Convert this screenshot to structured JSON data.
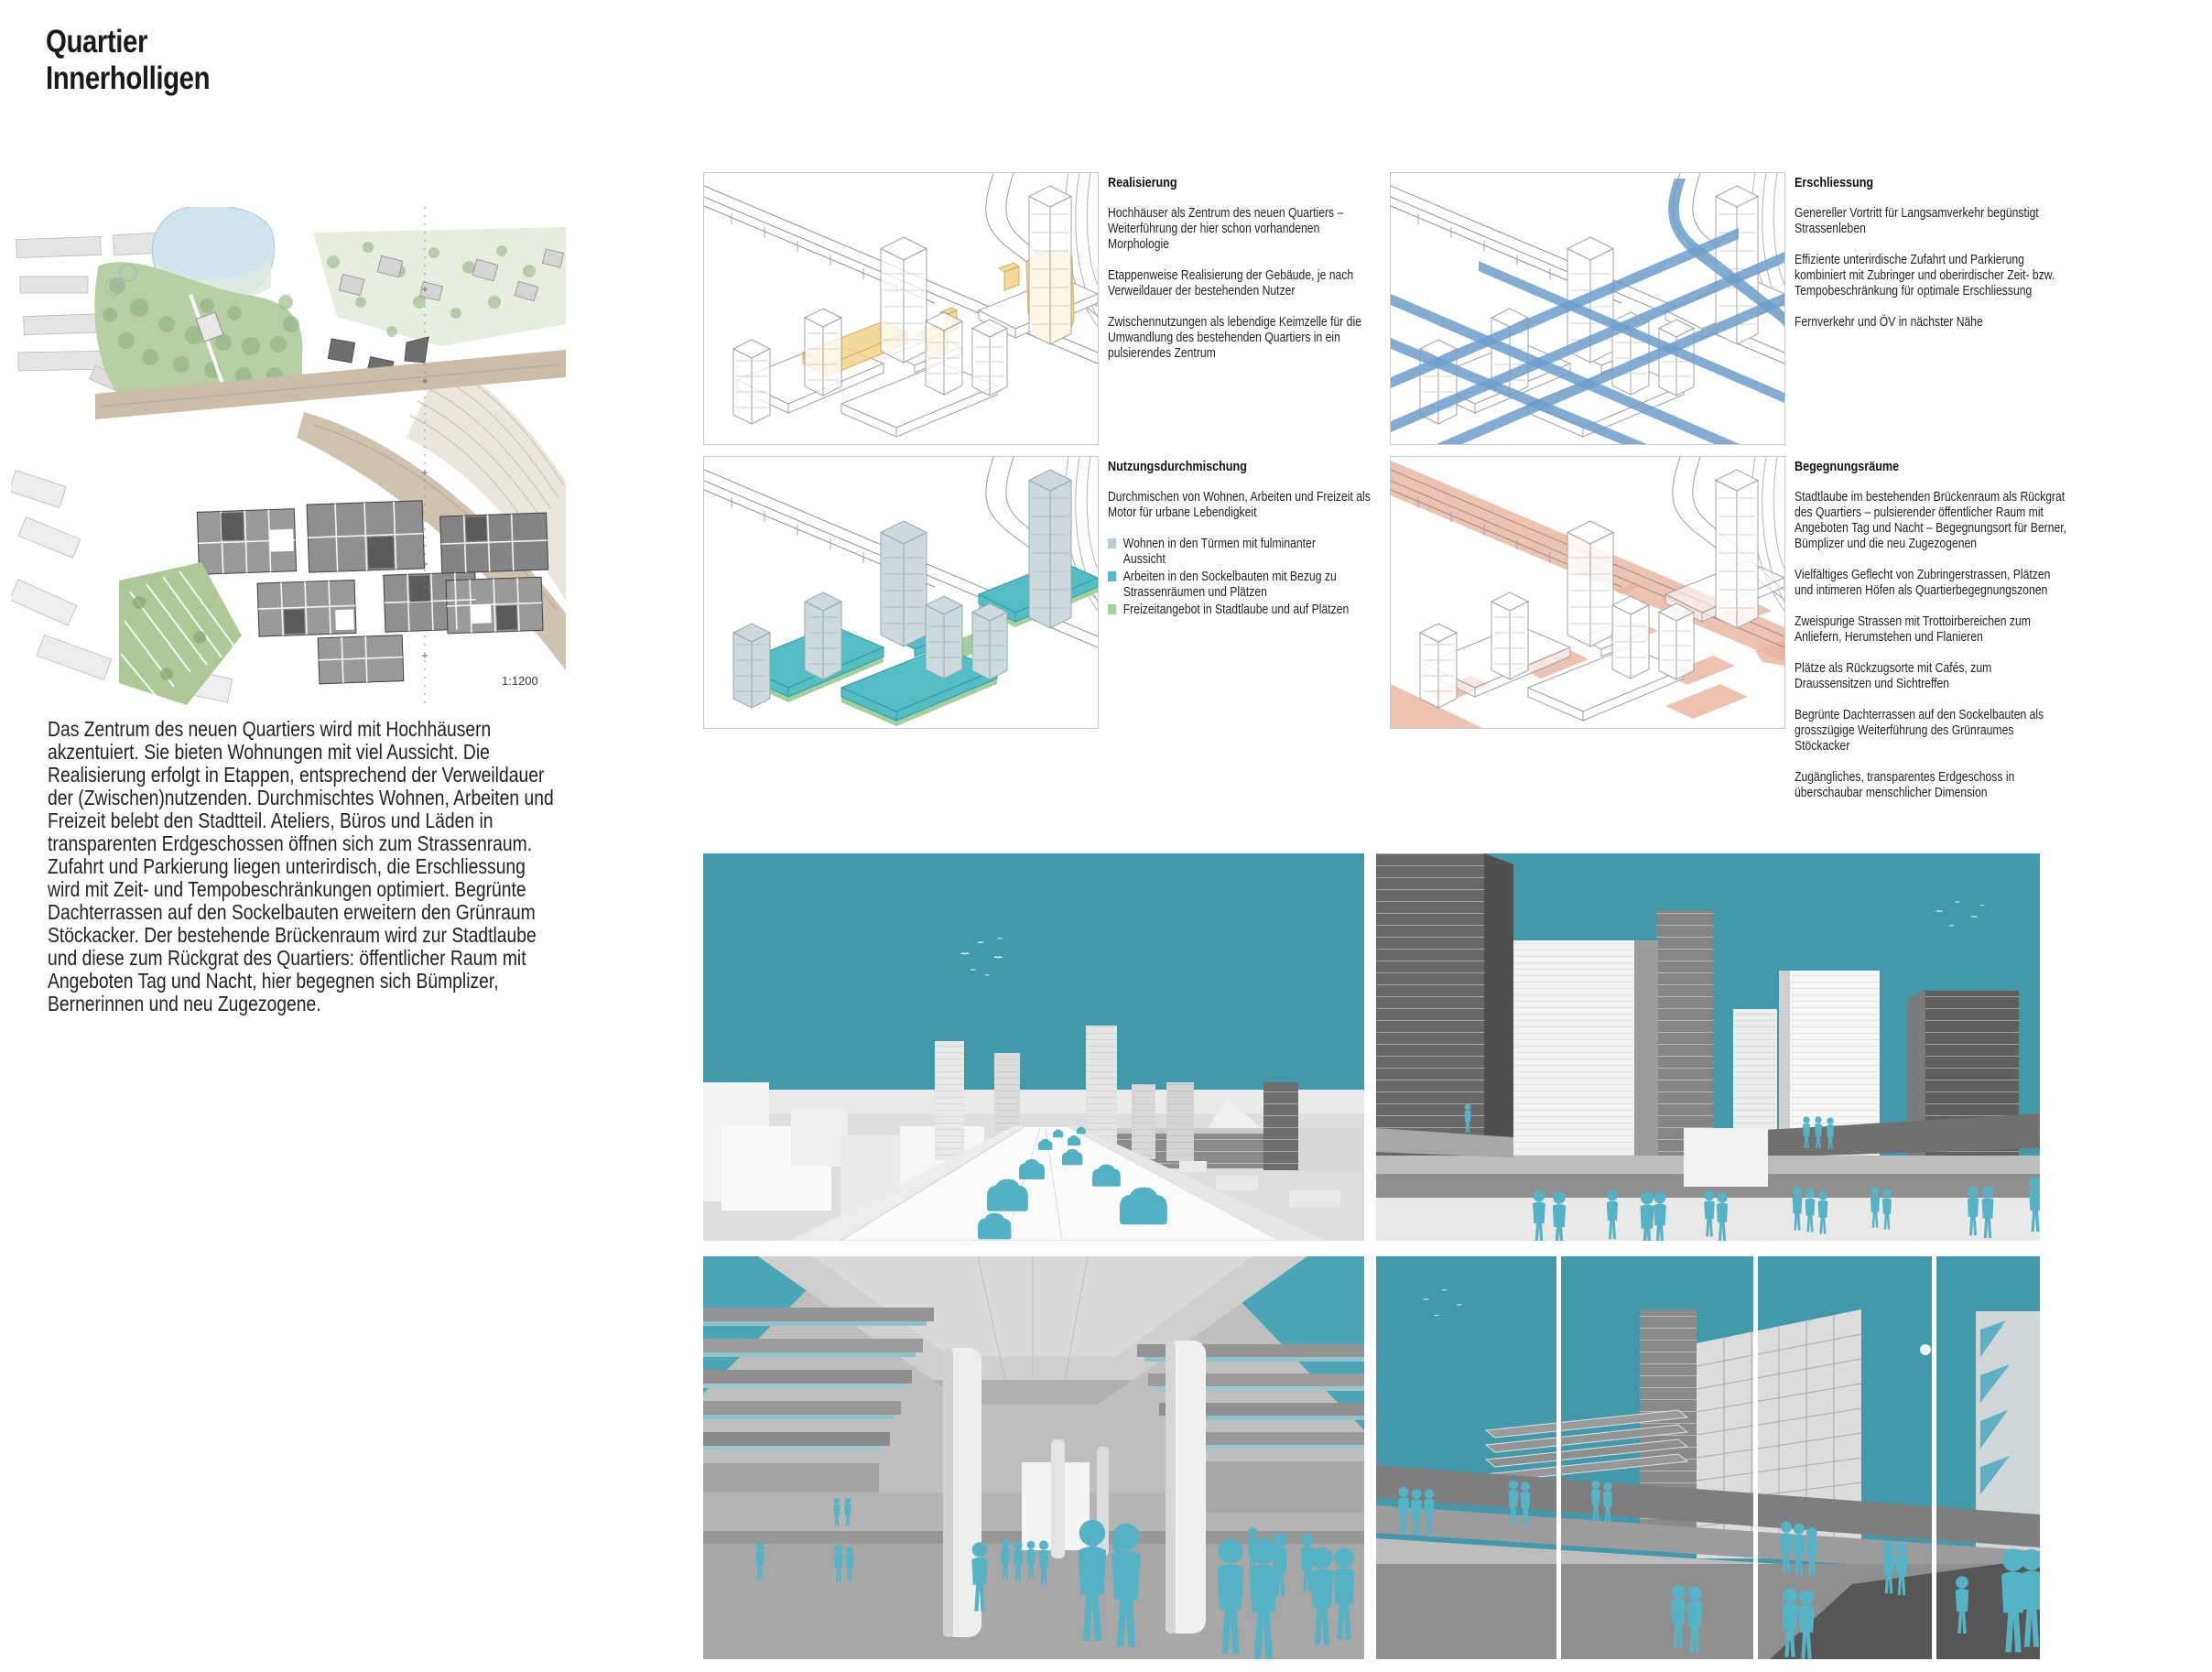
{
  "page": {
    "title_line1": "Quartier",
    "title_line2": "Innerholligen"
  },
  "map": {
    "scale_label": "1:1200"
  },
  "intro_paragraph": "Das Zentrum des neuen Quartiers wird mit Hochhäusern akzentuiert. Sie bieten Wohnungen mit viel Aussicht. Die Realisierung erfolgt in Etappen, entsprechend der Verweildauer der (Zwischen)nutzenden. Durchmischtes Wohnen, Arbeiten und Freizeit belebt den Stadtteil. Ateliers, Büros und Läden in transparenten Erdgeschossen öffnen sich zum Strassenraum. Zufahrt und Parkierung liegen unterirdisch, die Erschliessung wird mit Zeit- und Tempobeschränkungen optimiert. Begrünte Dachterrassen auf den Sockelbauten erweitern den Grünraum Stöckacker. Der bestehende Brückenraum wird zur Stadtlaube und diese zum Rückgrat des Quartiers: öffentlicher Raum mit Angeboten Tag und Nacht, hier begegnen sich Bümplizer, Bernerinnen und neu Zugezogene.",
  "sections": {
    "realisierung": {
      "heading": "Realisierung",
      "paragraphs": [
        "Hochhäuser als Zentrum des neuen Quartiers – Weiterführung der hier schon vorhandenen Morphologie",
        "Etappenweise Realisierung der Gebäude, je nach Verweildauer der bestehenden Nutzer",
        "Zwischennutzungen als lebendige Keimzelle für die Umwandlung des bestehenden Quartiers in ein pulsierendes Zentrum"
      ]
    },
    "erschliessung": {
      "heading": "Erschliessung",
      "paragraphs": [
        "Genereller Vortritt für Langsamverkehr begünstigt Strassenleben",
        "Effiziente unterirdische Zufahrt und Parkierung kombiniert mit Zubringer und oberirdischer Zeit- bzw. Tempobeschränkung für optimale Erschliessung",
        "Fernverkehr und ÖV in nächster Nähe"
      ]
    },
    "nutzungsdurchmischung": {
      "heading": "Nutzungsdurchmischung",
      "intro": "Durchmischen von Wohnen, Arbeiten und Freizeit als Motor für urbane Lebendigkeit",
      "legend": [
        {
          "color": "#b9cdd6",
          "label": "Wohnen in den Türmen mit fulminanter Aussicht"
        },
        {
          "color": "#5cb8c3",
          "label": "Arbeiten in den Sockelbauten mit Bezug zu Strassenräumen und Plätzen"
        },
        {
          "color": "#a3cf9b",
          "label": "Freizeitangebot in Stadtlaube und auf Plätzen"
        }
      ]
    },
    "begegnungsraeume": {
      "heading": "Begegnungsräume",
      "paragraphs": [
        "Stadtlaube im bestehenden Brückenraum als Rückgrat des Quartiers – pulsierender öffentlicher Raum mit Angeboten Tag und Nacht – Begegnungsort für Berner, Bümplizer und die neu Zugezogenen",
        "Vielfältiges Geflecht von Zubringerstrassen, Plätzen und intimeren Höfen als Quartierbegegnungszonen",
        "Zweispurige Strassen mit Trottoirbereichen zum Anliefern, Herumstehen und Flanieren",
        "Plätze als Rückzugsorte mit Cafés, zum Draussensitzen und Sichtreffen",
        "Begrünte Dachterrassen auf den Sockelbauten als grosszügige Weiterführung des Grünraumes Stöckacker",
        "Zugängliches, transparentes Erdgeschoss in überschaubar menschlicher Dimension"
      ]
    }
  },
  "colors": {
    "accent_yellow": "#f2d28b",
    "accent_blue": "#6d9dcb",
    "accent_teal": "#54bec7",
    "accent_green": "#a3cf9b",
    "accent_salmon": "#eab39e",
    "render_sky": "#4299ac",
    "render_figures": "#56b3c5"
  }
}
